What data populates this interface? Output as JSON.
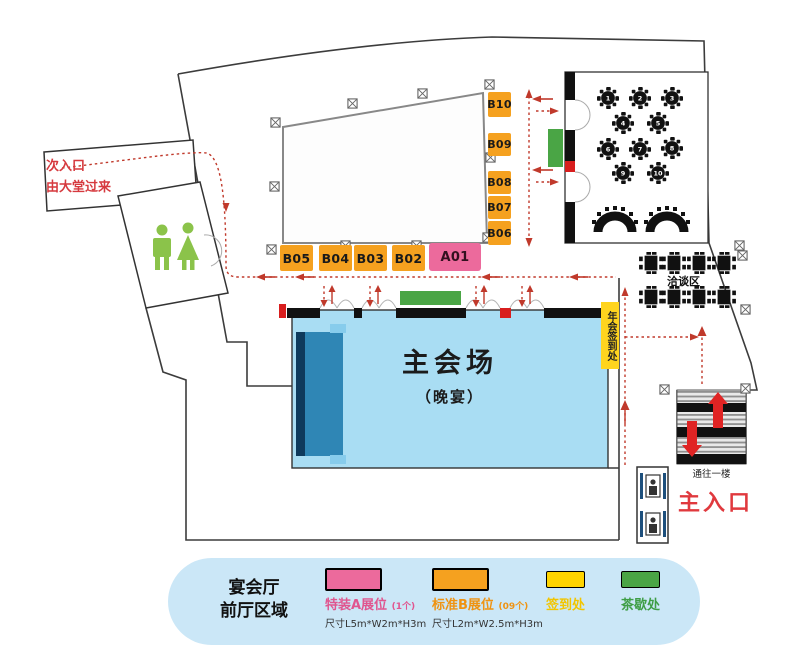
{
  "labels": {
    "secondary_entrance_line1": "次入口",
    "secondary_entrance_line2": "由大堂过来",
    "main_entrance": "主入口",
    "to_first_floor": "通往一楼",
    "negotiation_area": "洽谈区",
    "main_hall": "主会场",
    "main_hall_sub": "（晚宴）",
    "checkin_vertical": "年会签到处"
  },
  "booths": {
    "bottom_row": [
      "B05",
      "B04",
      "B03",
      "B02"
    ],
    "special": "A01",
    "right_column": [
      "B10",
      "B09",
      "B08",
      "B07",
      "B06"
    ]
  },
  "tables_room": {
    "table_numbers": [
      "1",
      "2",
      "3",
      "4",
      "5",
      "6",
      "7",
      "8",
      "9",
      "10"
    ]
  },
  "legend": {
    "area_title_line1": "宴会厅",
    "area_title_line2": "前厅区域",
    "items": [
      {
        "name": "特装A展位",
        "count": "(1个)",
        "size": "尺寸L5m*W2m*H3m",
        "color": "#ec6a9c",
        "border": "#c04a7e",
        "text_color": "#e0558f"
      },
      {
        "name": "标准B展位",
        "count": "(09个)",
        "size": "尺寸L2m*W2.5m*H3m",
        "color": "#f5a11f",
        "border": "#d8860f",
        "text_color": "#ef9312"
      },
      {
        "name": "签到处",
        "color": "#ffd400",
        "border": "#e0b800",
        "text_color": "#f2c500"
      },
      {
        "name": "茶歇处",
        "color": "#4aa545",
        "border": "#37853c",
        "text_color": "#3f9e46"
      }
    ]
  },
  "colors": {
    "hall_blue": "#a9ddf3",
    "stage_blue": "#2f86b5",
    "booth_orange": "#f5a11f",
    "special_pink": "#ec6a9c",
    "checkin_yellow": "#ffd41e",
    "tea_green": "#4aa545",
    "flow_red": "#c0392b",
    "entrance_red": "#e0393e",
    "legend_bg": "#cbe7f7",
    "wall_black": "#111111",
    "restroom_green": "#8bc34a"
  }
}
